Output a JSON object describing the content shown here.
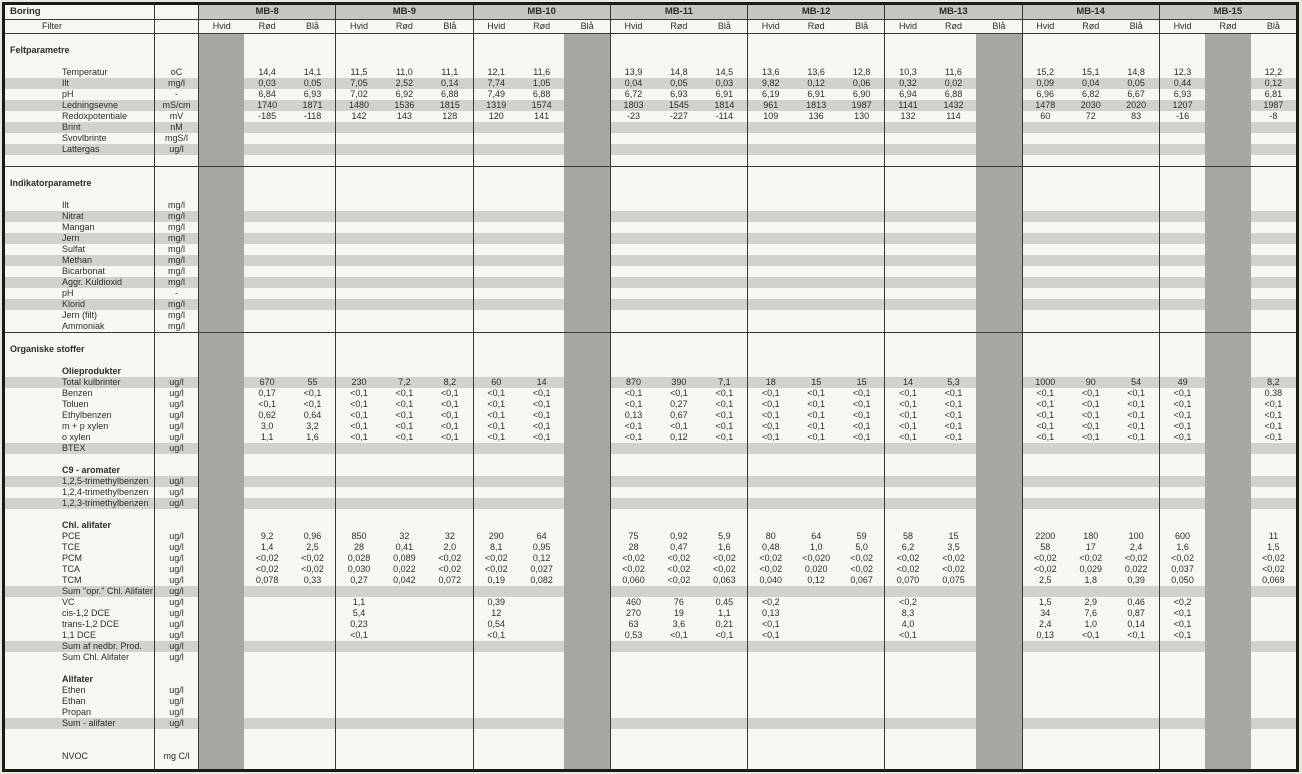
{
  "table": {
    "corner_label": "Boring",
    "filter_label": "Filter",
    "borings": [
      "MB-8",
      "MB-9",
      "MB-10",
      "MB-11",
      "MB-12",
      "MB-13",
      "MB-14",
      "MB-15"
    ],
    "filters": [
      "Hvid",
      "Rød",
      "Blå"
    ],
    "disabled_columns": [
      0,
      8,
      17,
      22
    ],
    "colors": {
      "disabled_band": "#a8a7a1",
      "row_stripe": "#d3d1cb",
      "boring_header_bg": "#c6c5bf",
      "grid_line": "#3a3833",
      "paper": "#f7f6f1"
    },
    "rows": [
      {
        "type": "blank"
      },
      {
        "type": "section",
        "label": "Feltparametre"
      },
      {
        "type": "blank"
      },
      {
        "type": "param",
        "label": "Temperatur",
        "unit": "oC",
        "values": [
          "",
          "14,4",
          "14,1",
          "11,5",
          "11,0",
          "11,1",
          "12,1",
          "11,6",
          "",
          "13,9",
          "14,8",
          "14,5",
          "13,6",
          "13,6",
          "12,8",
          "10,3",
          "11,6",
          "",
          "15,2",
          "15,1",
          "14,8",
          "12,3",
          "",
          "12,2"
        ]
      },
      {
        "type": "param",
        "label": "Ilt",
        "unit": "mg/l",
        "striped": true,
        "values": [
          "",
          "0,03",
          "0,05",
          "7,05",
          "2,52",
          "0,14",
          "7,74",
          "1,05",
          "",
          "0,04",
          "0,05",
          "0,03",
          "9,82",
          "0,12",
          "0,06",
          "0,32",
          "0,02",
          "",
          "0,09",
          "0,04",
          "0,05",
          "0,44",
          "",
          "0,12"
        ]
      },
      {
        "type": "param",
        "label": "pH",
        "unit": "-",
        "values": [
          "",
          "6,84",
          "6,93",
          "7,02",
          "6,92",
          "6,88",
          "7,49",
          "6,88",
          "",
          "6,72",
          "6,93",
          "6,91",
          "6,19",
          "6,91",
          "6,90",
          "6,94",
          "6,88",
          "",
          "6,96",
          "6,82",
          "6,67",
          "6,93",
          "",
          "6,81"
        ]
      },
      {
        "type": "param",
        "label": "Ledningsevne",
        "unit": "mS/cm",
        "striped": true,
        "values": [
          "",
          "1740",
          "1871",
          "1480",
          "1536",
          "1815",
          "1319",
          "1574",
          "",
          "1803",
          "1545",
          "1814",
          "961",
          "1813",
          "1987",
          "1141",
          "1432",
          "",
          "1478",
          "2030",
          "2020",
          "1207",
          "",
          "1987"
        ]
      },
      {
        "type": "param",
        "label": "Redoxpotentiale",
        "unit": "mV",
        "values": [
          "",
          "-185",
          "-118",
          "142",
          "143",
          "128",
          "120",
          "141",
          "",
          "-23",
          "-227",
          "-114",
          "109",
          "136",
          "130",
          "132",
          "114",
          "",
          "60",
          "72",
          "83",
          "-16",
          "",
          "-8"
        ]
      },
      {
        "type": "param",
        "label": "Brint",
        "unit": "nM",
        "striped": true
      },
      {
        "type": "param",
        "label": "Svovlbrinte",
        "unit": "mgS/l"
      },
      {
        "type": "param",
        "label": "Lattergas",
        "unit": "ug/l",
        "striped": true
      },
      {
        "type": "blank",
        "divider": true
      },
      {
        "type": "blank"
      },
      {
        "type": "section",
        "label": "Indikatorparametre"
      },
      {
        "type": "blank"
      },
      {
        "type": "param",
        "label": "Ilt",
        "unit": "mg/l"
      },
      {
        "type": "param",
        "label": "Nitrat",
        "unit": "mg/l",
        "striped": true
      },
      {
        "type": "param",
        "label": "Mangan",
        "unit": "mg/l"
      },
      {
        "type": "param",
        "label": "Jern",
        "unit": "mg/l",
        "striped": true
      },
      {
        "type": "param",
        "label": "Sulfat",
        "unit": "mg/l"
      },
      {
        "type": "param",
        "label": "Methan",
        "unit": "mg/l",
        "striped": true
      },
      {
        "type": "param",
        "label": "Bicarbonat",
        "unit": "mg/l"
      },
      {
        "type": "param",
        "label": "Aggr. Kuldioxid",
        "unit": "mg/l",
        "striped": true
      },
      {
        "type": "param",
        "label": "pH",
        "unit": "-"
      },
      {
        "type": "param",
        "label": "Klorid",
        "unit": "mg/l",
        "striped": true
      },
      {
        "type": "param",
        "label": "Jern (filt)",
        "unit": "mg/l"
      },
      {
        "type": "param",
        "label": "Ammoniak",
        "unit": "mg/l",
        "divider": true
      },
      {
        "type": "blank"
      },
      {
        "type": "section",
        "label": "Organiske stoffer"
      },
      {
        "type": "blank"
      },
      {
        "type": "subhead",
        "label": "Olieprodukter"
      },
      {
        "type": "param",
        "label": "Total kulbrinter",
        "unit": "ug/l",
        "striped": true,
        "values": [
          "",
          "670",
          "55",
          "230",
          "7,2",
          "8,2",
          "60",
          "14",
          "",
          "870",
          "390",
          "7,1",
          "18",
          "15",
          "15",
          "14",
          "5,3",
          "",
          "1000",
          "90",
          "54",
          "49",
          "",
          "8,2"
        ]
      },
      {
        "type": "param",
        "label": "Benzen",
        "unit": "ug/l",
        "values": [
          "",
          "0,17",
          "<0,1",
          "<0,1",
          "<0,1",
          "<0,1",
          "<0,1",
          "<0,1",
          "",
          "<0,1",
          "<0,1",
          "<0,1",
          "<0,1",
          "<0,1",
          "<0,1",
          "<0,1",
          "<0,1",
          "",
          "<0,1",
          "<0,1",
          "<0,1",
          "<0,1",
          "",
          "0,38"
        ]
      },
      {
        "type": "param",
        "label": "Toluen",
        "unit": "ug/l",
        "values": [
          "",
          "<0,1",
          "<0,1",
          "<0,1",
          "<0,1",
          "<0,1",
          "<0,1",
          "<0,1",
          "",
          "<0,1",
          "0,27",
          "<0,1",
          "<0,1",
          "<0,1",
          "<0,1",
          "<0,1",
          "<0,1",
          "",
          "<0,1",
          "<0,1",
          "<0,1",
          "<0,1",
          "",
          "<0,1"
        ]
      },
      {
        "type": "param",
        "label": "Ethylbenzen",
        "unit": "ug/l",
        "values": [
          "",
          "0,62",
          "0,64",
          "<0,1",
          "<0,1",
          "<0,1",
          "<0,1",
          "<0,1",
          "",
          "0,13",
          "0,67",
          "<0,1",
          "<0,1",
          "<0,1",
          "<0,1",
          "<0,1",
          "<0,1",
          "",
          "<0,1",
          "<0,1",
          "<0,1",
          "<0,1",
          "",
          "<0,1"
        ]
      },
      {
        "type": "param",
        "label": "m + p xylen",
        "unit": "ug/l",
        "values": [
          "",
          "3,0",
          "3,2",
          "<0,1",
          "<0,1",
          "<0,1",
          "<0,1",
          "<0,1",
          "",
          "<0,1",
          "<0,1",
          "<0,1",
          "<0,1",
          "<0,1",
          "<0,1",
          "<0,1",
          "<0,1",
          "",
          "<0,1",
          "<0,1",
          "<0,1",
          "<0,1",
          "",
          "<0,1"
        ]
      },
      {
        "type": "param",
        "label": "o xylen",
        "unit": "ug/l",
        "values": [
          "",
          "1,1",
          "1,6",
          "<0,1",
          "<0,1",
          "<0,1",
          "<0,1",
          "<0,1",
          "",
          "<0,1",
          "0,12",
          "<0,1",
          "<0,1",
          "<0,1",
          "<0,1",
          "<0,1",
          "<0,1",
          "",
          "<0,1",
          "<0,1",
          "<0,1",
          "<0,1",
          "",
          "<0,1"
        ]
      },
      {
        "type": "param",
        "label": "BTEX",
        "unit": "ug/l",
        "striped": true
      },
      {
        "type": "blank"
      },
      {
        "type": "subhead",
        "label": "C9 - aromater"
      },
      {
        "type": "param",
        "label": "1,2,5-trimethylbenzen",
        "unit": "ug/l",
        "striped": true
      },
      {
        "type": "param",
        "label": "1,2,4-trimethylbenzen",
        "unit": "ug/l"
      },
      {
        "type": "param",
        "label": "1,2,3-trimethylbenzen",
        "unit": "ug/l",
        "striped": true
      },
      {
        "type": "blank"
      },
      {
        "type": "subhead",
        "label": "Chl. alifater"
      },
      {
        "type": "param",
        "label": "PCE",
        "unit": "ug/l",
        "values": [
          "",
          "9,2",
          "0,96",
          "850",
          "32",
          "32",
          "290",
          "64",
          "",
          "75",
          "0,92",
          "5,9",
          "80",
          "64",
          "59",
          "58",
          "15",
          "",
          "2200",
          "180",
          "100",
          "600",
          "",
          "11"
        ]
      },
      {
        "type": "param",
        "label": "TCE",
        "unit": "ug/l",
        "values": [
          "",
          "1,4",
          "2,5",
          "28",
          "0,41",
          "2,0",
          "8,1",
          "0,95",
          "",
          "28",
          "0,47",
          "1,6",
          "0,48",
          "1,0",
          "5,0",
          "6,2",
          "3,5",
          "",
          "58",
          "17",
          "2,4",
          "1,6",
          "",
          "1,5"
        ]
      },
      {
        "type": "param",
        "label": "PCM",
        "unit": "ug/l",
        "values": [
          "",
          "<0,02",
          "<0,02",
          "0,028",
          "0,089",
          "<0,02",
          "<0,02",
          "0,12",
          "",
          "<0,02",
          "<0,02",
          "<0,02",
          "<0,02",
          "<0,020",
          "<0,02",
          "<0,02",
          "<0,02",
          "",
          "<0,02",
          "<0,02",
          "<0,02",
          "<0,02",
          "",
          "<0,02"
        ]
      },
      {
        "type": "param",
        "label": "TCA",
        "unit": "ug/l",
        "values": [
          "",
          "<0,02",
          "<0,02",
          "0,030",
          "0,022",
          "<0,02",
          "<0,02",
          "0,027",
          "",
          "<0,02",
          "<0,02",
          "<0,02",
          "<0,02",
          "0,020",
          "<0,02",
          "<0,02",
          "<0,02",
          "",
          "<0,02",
          "0,029",
          "0,022",
          "0,037",
          "",
          "<0,02"
        ]
      },
      {
        "type": "param",
        "label": "TCM",
        "unit": "ug/l",
        "values": [
          "",
          "0,078",
          "0,33",
          "0,27",
          "0,042",
          "0,072",
          "0,19",
          "0,082",
          "",
          "0,060",
          "<0,02",
          "0,063",
          "0,040",
          "0,12",
          "0,067",
          "0,070",
          "0,075",
          "",
          "2,5",
          "1,8",
          "0,39",
          "0,050",
          "",
          "0,069"
        ]
      },
      {
        "type": "param",
        "label": "Sum \"opr.\" Chl. Alifater",
        "unit": "ug/l",
        "striped": true
      },
      {
        "type": "param",
        "label": "VC",
        "unit": "ug/l",
        "values": [
          "",
          "",
          "",
          "1,1",
          "",
          "",
          "0,39",
          "",
          "",
          "460",
          "76",
          "0,45",
          "<0,2",
          "",
          "",
          "<0,2",
          "",
          "",
          "1,5",
          "2,9",
          "0,46",
          "<0,2",
          "",
          ""
        ]
      },
      {
        "type": "param",
        "label": "cis-1,2 DCE",
        "unit": "ug/l",
        "values": [
          "",
          "",
          "",
          "5,4",
          "",
          "",
          "12",
          "",
          "",
          "270",
          "19",
          "1,1",
          "0,13",
          "",
          "",
          "8,3",
          "",
          "",
          "34",
          "7,6",
          "0,87",
          "<0,1",
          "",
          ""
        ]
      },
      {
        "type": "param",
        "label": "trans-1,2 DCE",
        "unit": "ug/l",
        "values": [
          "",
          "",
          "",
          "0,23",
          "",
          "",
          "0,54",
          "",
          "",
          "63",
          "3,6",
          "0,21",
          "<0,1",
          "",
          "",
          "4,0",
          "",
          "",
          "2,4",
          "1,0",
          "0,14",
          "<0,1",
          "",
          ""
        ]
      },
      {
        "type": "param",
        "label": "1,1 DCE",
        "unit": "ug/l",
        "values": [
          "",
          "",
          "",
          "<0,1",
          "",
          "",
          "<0,1",
          "",
          "",
          "0,53",
          "<0,1",
          "<0,1",
          "<0,1",
          "",
          "",
          "<0,1",
          "",
          "",
          "0,13",
          "<0,1",
          "<0,1",
          "<0,1",
          "",
          ""
        ]
      },
      {
        "type": "param",
        "label": "Sum af nedbr. Prod.",
        "unit": "ug/l",
        "striped": true
      },
      {
        "type": "param",
        "label": "Sum Chl. Alifater",
        "unit": "ug/l"
      },
      {
        "type": "blank"
      },
      {
        "type": "subhead",
        "label": "Alifater"
      },
      {
        "type": "param",
        "label": "Ethen",
        "unit": "ug/l"
      },
      {
        "type": "param",
        "label": "Ethan",
        "unit": "ug/l"
      },
      {
        "type": "param",
        "label": "Propan",
        "unit": "ug/l"
      },
      {
        "type": "param",
        "label": "Sum - alifater",
        "unit": "ug/l",
        "striped": true
      },
      {
        "type": "blank"
      },
      {
        "type": "blank"
      },
      {
        "type": "param",
        "label": "NVOC",
        "unit": "mg C/l"
      },
      {
        "type": "blank"
      }
    ]
  }
}
